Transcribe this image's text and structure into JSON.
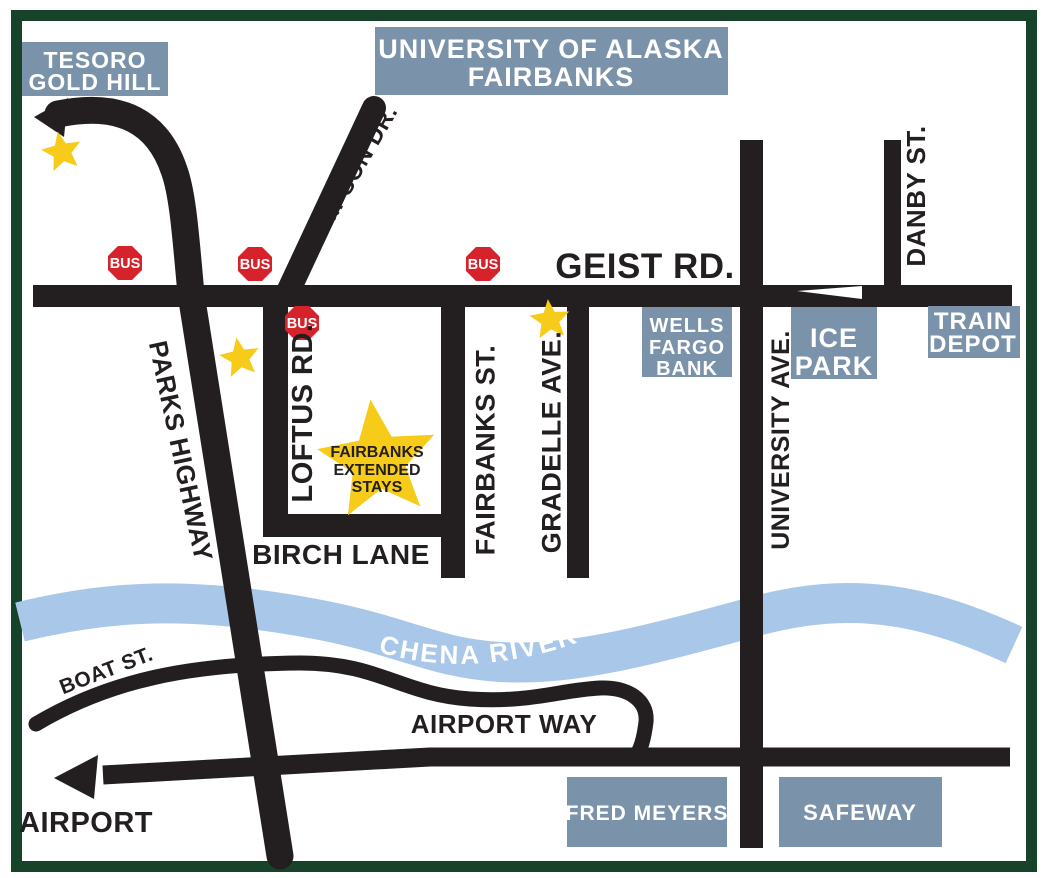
{
  "map_title": "Fairbanks area access map",
  "colors": {
    "border_green": "#16432a",
    "road_black": "#231f20",
    "river_blue": "#a9c8e9",
    "landmark_box_blue": "#7b93aa",
    "bus_sign_red": "#d6222a",
    "star_yellow": "#f6cb1a",
    "label_black": "#231f20",
    "label_white": "#ffffff"
  },
  "landmarks": {
    "tesoro": {
      "line1": "TESORO",
      "line2": "GOLD HILL"
    },
    "university": {
      "line1": "UNIVERSITY OF ALASKA",
      "line2": "FAIRBANKS"
    },
    "wells_fargo": {
      "line1": "WELLS",
      "line2": "FARGO",
      "line3": "BANK"
    },
    "ice_park": {
      "line1": "ICE",
      "line2": "PARK"
    },
    "train_depot": {
      "line1": "TRAIN",
      "line2": "DEPOT"
    },
    "fred_meyers": {
      "label": "FRED MEYERS"
    },
    "safeway": {
      "label": "SAFEWAY"
    }
  },
  "roads": {
    "geist": "GEIST RD.",
    "thompson": "THOMPSON DR.",
    "parks_highway": "PARKS HIGHWAY",
    "loftus": "LOFTUS RD.",
    "fairbanks_st": "FAIRBANKS ST.",
    "gradelle": "GRADELLE AVE.",
    "university_ave": "UNIVERSITY AVE.",
    "danby": "DANBY ST.",
    "birch_lane": "BIRCH LANE",
    "boat_st": "BOAT ST.",
    "airport_way": "AIRPORT WAY"
  },
  "destinations": {
    "airport": "AIRPORT"
  },
  "river": {
    "label": "CHENA RIVER"
  },
  "property_star": {
    "line1": "FAIRBANKS",
    "line2": "EXTENDED",
    "line3": "STAYS"
  },
  "bus": {
    "label": "BUS"
  }
}
